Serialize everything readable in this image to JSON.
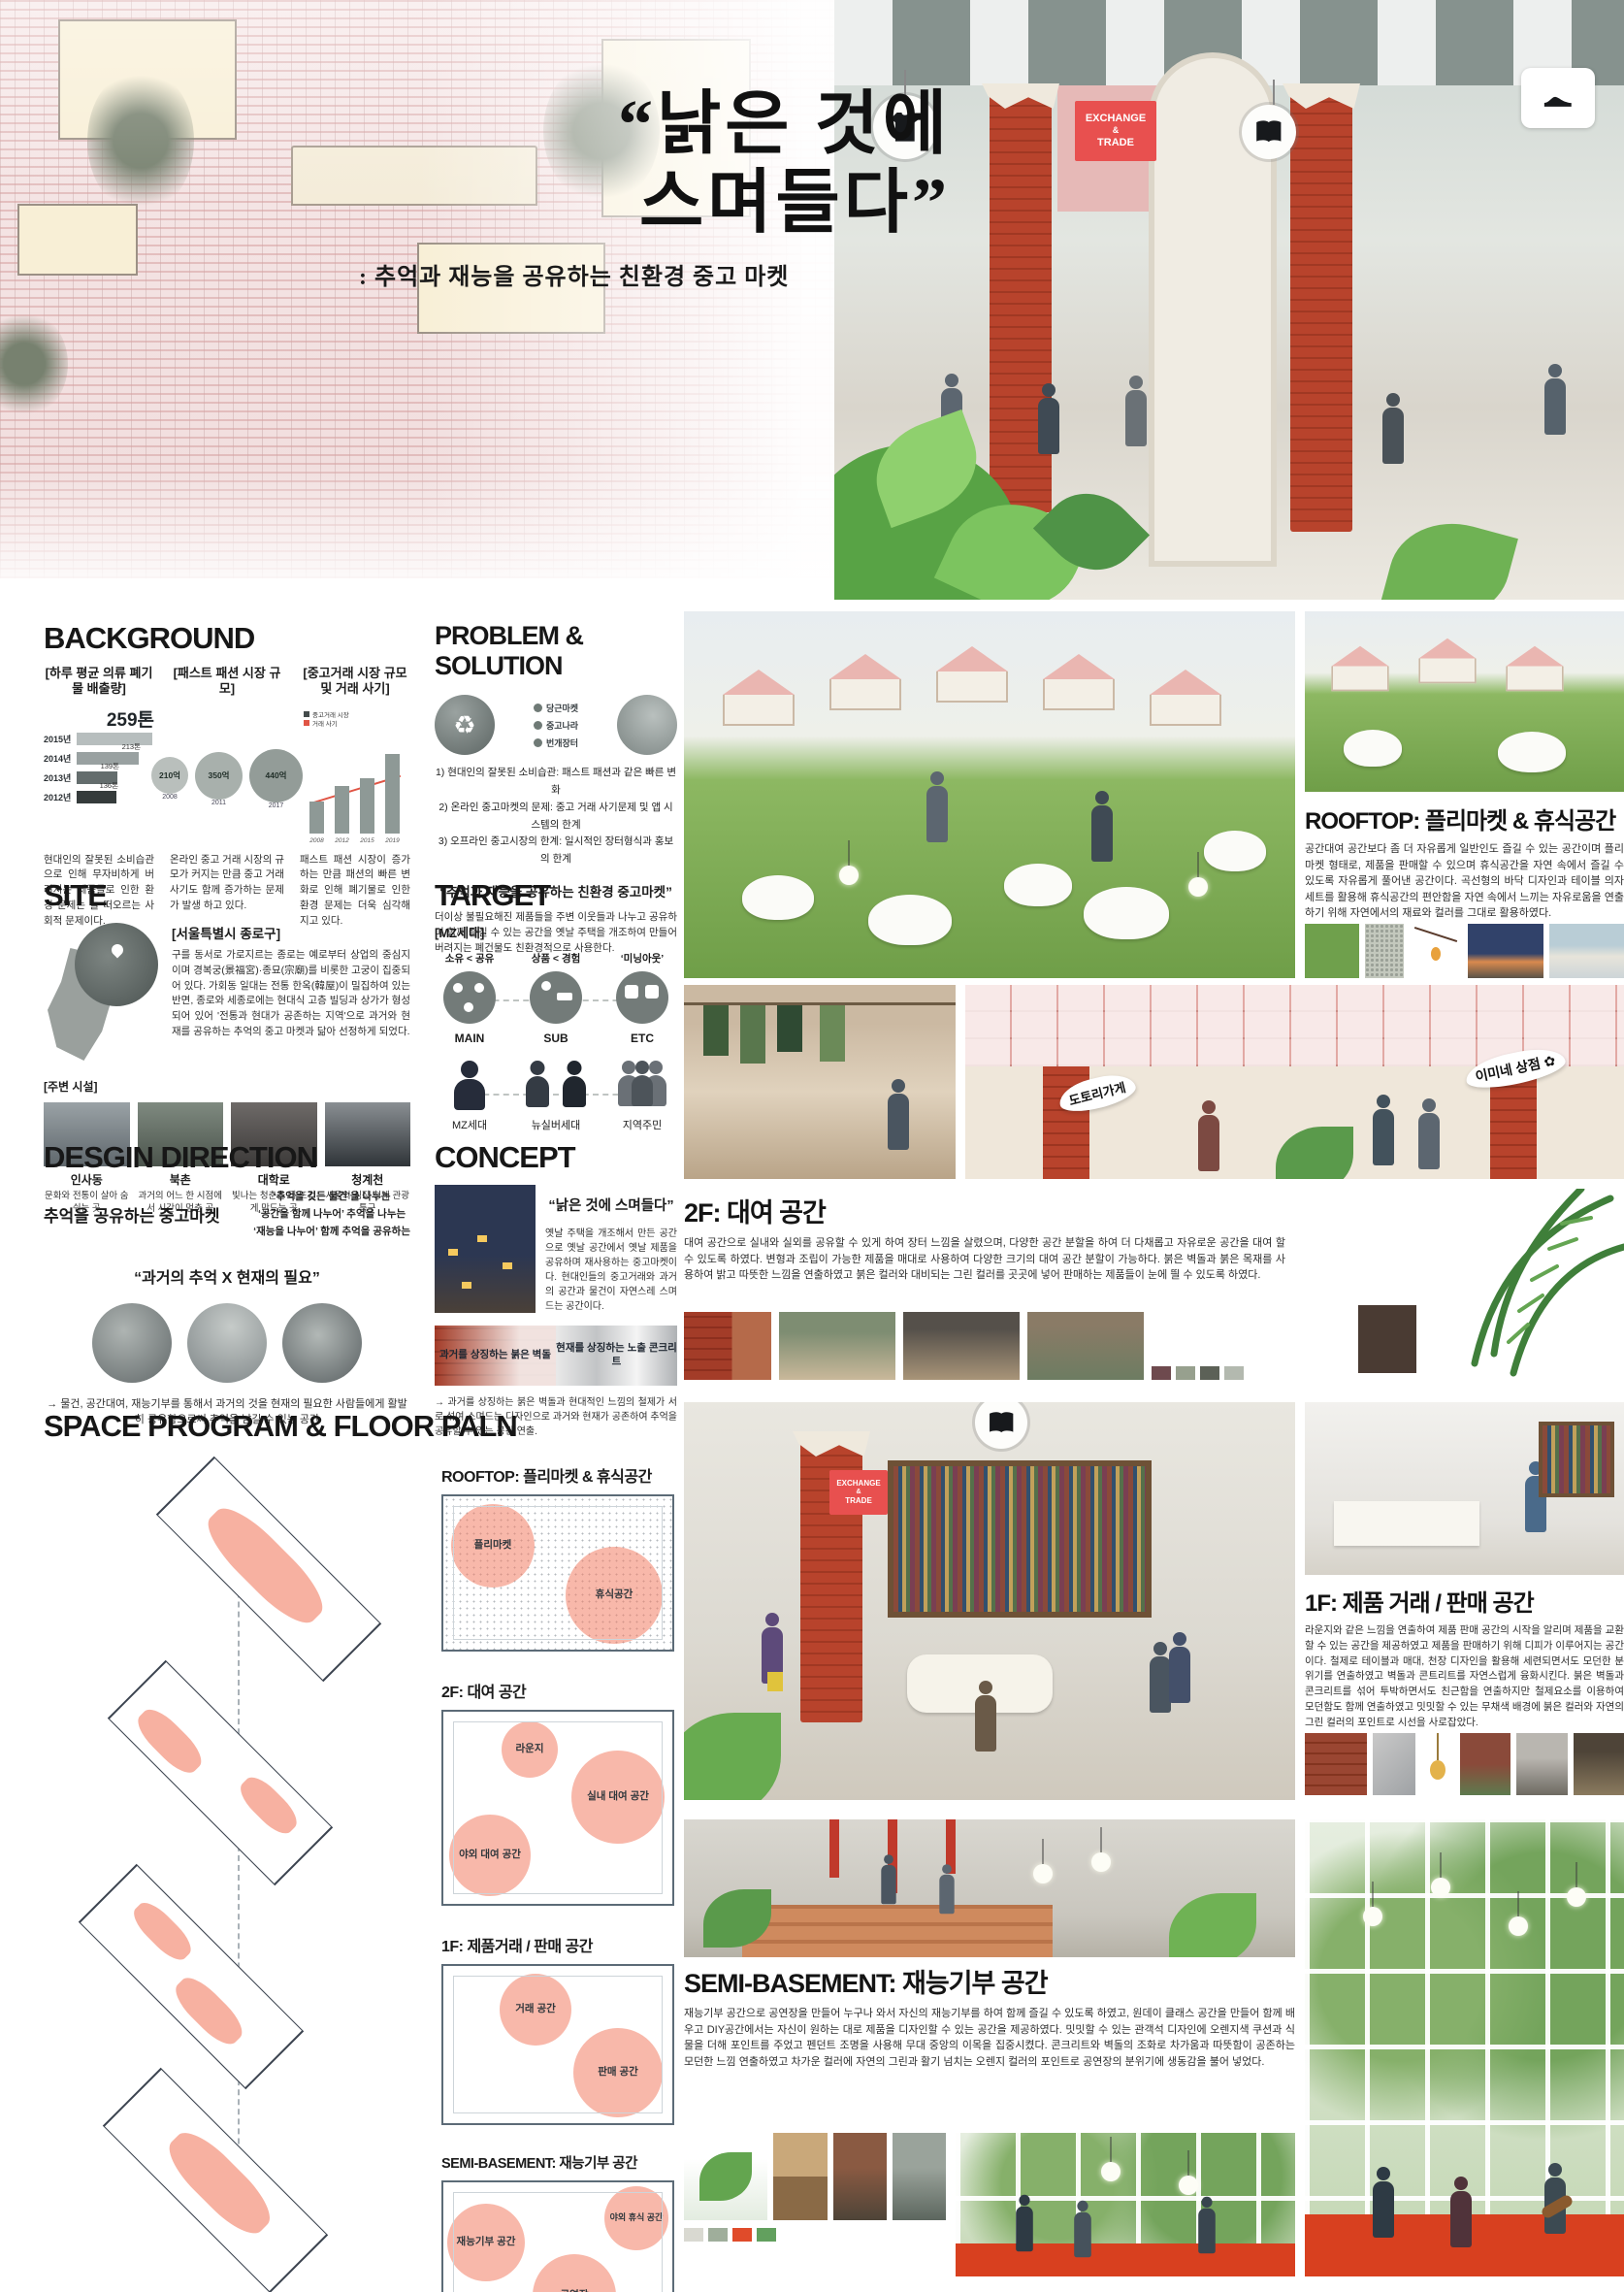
{
  "colors": {
    "accent_pink": "#f2a08e",
    "zone_pink": "#f07d64",
    "brick_red": "#b8432c",
    "sign_red": "#e8504f",
    "leaf_green": "#6fb254"
  },
  "hero": {
    "title_line1": "“낡은 것에",
    "title_line2": "스며들다”",
    "subtitle": ": 추억과 재능을 공유하는 친환경 중고 마켓",
    "sign": {
      "line1": "EXCHANGE",
      "amp": "&",
      "line2": "TRADE"
    }
  },
  "background": {
    "title": "BACKGROUND",
    "charts": [
      {
        "label": "[하루 평균 의류 폐기물 배출량]",
        "highlight": "259톤",
        "desc": "현대인의 잘못된 소비습관 으로 인해 무자비하게 버려지는 제품들로 인한 환경 문제는 늘 떠오르는 사회적 문제이다."
      },
      {
        "label": "[패스트 패션 시장 규모]",
        "desc": "온라인 중고 거래 시장의 규모가 커지는 만큼 중고 거래 사기도 함께 증가하는 문제가 발생 하고 있다."
      },
      {
        "label": "[중고거래 시장 규모 및 거래 사기]",
        "desc": "패스트 패션 시장이 증가하는 만큼 패션의 빠른 변화로 인해 폐기물로 인한 환경 문제는 더욱 심각해지고 있다."
      }
    ]
  },
  "problem_solution": {
    "title": "PROBLEM & SOLUTION",
    "apps": [
      "당근마켓",
      "중고나라",
      "번개장터"
    ],
    "items": [
      "1) 현대인의 잘못된 소비습관: 패스트 패션과 같은 빠른 변화",
      "2) 온라인 중고마켓의 문제: 중고 거래 사기문제 및 앱 시스템의 한계",
      "3) 오프라인 중고시장의 한계: 일시적인 장터형식과 홍보의 한계"
    ],
    "quote": "“추억과 재능을 공유하는 친환경 중고마켓”",
    "desc": "더이상 불필요해진 제품들을 주변 이웃들과 나누고 공유하며 함께 즐길 수 있는 공간을 옛날 주택을 개조하여 만들어 버려지는 폐건물도 친환경적으로 사용한다."
  },
  "site": {
    "title": "SITE",
    "location_label": "[서울특별시 종로구]",
    "desc": "구를 동서로 가로지르는 종로는 예로부터 상업의 중심지이며 경복궁(景福宮)·종묘(宗廟)를 비롯한 고궁이 집중되어 있다. 가회동 일대는 전통 한옥(韓屋)이 밀집하여 있는 반면, 종로와 세종로에는 현대식 고층 빌딩과 상가가 형성되어 있어 '전통과 현대가 공존하는 지역'으로 과거와 현재를 공유하는 추억의 중고 마켓과 닮아 선정하게 되었다.",
    "nearby_label": "[주변 시설]",
    "places": [
      {
        "name": "인사동",
        "desc": "문화와 전통이 살아 숨쉬는 곳"
      },
      {
        "name": "북촌",
        "desc": "과거의 어느 한 시점에서 시간이 멈춘 곳"
      },
      {
        "name": "대학로",
        "desc": "빛나는 청춘을 더 뜨겁게 만드는 곳"
      },
      {
        "name": "청계천",
        "desc": "서울의 심장 청계 관광특구"
      }
    ]
  },
  "target": {
    "title": "TARGET",
    "gen_label": "[MZ세대]",
    "traits": [
      "소유 < 공유",
      "상품 < 경험",
      "‘미닝아웃’"
    ],
    "tiers": [
      "MAIN",
      "SUB",
      "ETC"
    ],
    "groups": [
      "MZ세대",
      "뉴실버세대",
      "지역주민"
    ]
  },
  "design_direction": {
    "title": "DESGIN DIRECTION",
    "phrase": "추억을 공유하는 중고마켓",
    "notes": [
      "‘추억을 깃든 물건’을 나누는",
      "‘공간을 함께 나누어’ 추억을 나누는",
      "‘재능을 나누어’ 함께 추억을 공유하는"
    ],
    "quote": "“과거의 추억 X 현재의 필요”",
    "conclusion": "→ 물건, 공간대여, 재능기부를 통해서 과거의 것을 현재의 필요한 사람들에게 활발히 공유함으로써 추억을 남길 수 있는 공간"
  },
  "concept": {
    "title": "CONCEPT",
    "quote": "“낡은 것에 스며들다”",
    "desc": "옛날 주택을 개조해서 만든 공간으로 옛날 공간에서 옛날 제품을 공유하며 재사용하는 중고마켓이다. 현대인들의 중고거래와 과거의 공간과 물건이 자연스레 스며드는 공간이다.",
    "materials": [
      "과거를 상징하는 붉은 벽돌",
      "현재를 상징하는 노출 콘크리트"
    ],
    "conclusion": "→ 과거를 상징하는 붉은 벽돌과 현대적인 느낌의 철제가 서로 섞여 스며드는 디자인으로 과거와 현재가 공존하여 추억을 공유할 수 있는 공간 연출."
  },
  "space_program": {
    "title": "SPACE PROGRAM & FLOOR PALN",
    "plans": [
      {
        "heading": "ROOFTOP: 플리마켓 & 휴식공간",
        "zones": [
          "플리마켓",
          "휴식공간"
        ]
      },
      {
        "heading": "2F: 대여 공간",
        "zones": [
          "라운지",
          "실내 대여 공간",
          "야외 대여 공간"
        ]
      },
      {
        "heading": "1F: 제품거래 / 판매 공간",
        "zones": [
          "거래 공간",
          "판매 공간"
        ]
      },
      {
        "heading": "SEMI-BASEMENT: 재능기부 공간",
        "zones": [
          "재능기부 공간",
          "공연장",
          "야외 휴식 공간"
        ]
      }
    ]
  },
  "rooftop": {
    "title": "ROOFTOP: 플리마켓 & 휴식공간",
    "desc": "공간대여 공간보다 좀 더 자유롭게 일반인도 즐길 수 있는 공간이며 플리마켓 형태로, 제품을 판매할 수 있으며 휴식공간을 자연 속에서 즐길 수 있도록 자유롭게 풀어낸 공간이다. 곡선형의 바닥 디자인과 테이블 의자 세트를 활용해 휴식공간의 편안함을 자연 속에서 느끼는 자유로움을 연출하기 위해 자연에서의 재료와 컬러를 그대로 활용하였다."
  },
  "f2": {
    "title": "2F: 대여 공간",
    "desc": "대여 공간으로 실내와 실외를 공유할 수 있게 하여 장터 느낌을 살렸으며, 다양한 공간 분할을 하여 더 다채롭고 자유로운 공간을 대여 할 수 있도록 하였다. 변형과 조립이 가능한 제품을 매대로 사용하여 다양한 크기의 대여 공간 분할이 가능하다. 붉은 벽돌과 붉은 목재를 사용하여 밝고 따뜻한 느낌을 연출하였고 붉은 컬러와 대비되는 그린 컬러를 곳곳에 넣어 판매하는 제품들이 눈에 띌 수 있도록 하였다.",
    "banners": [
      "도토리가게",
      "이미네 상점"
    ],
    "palette": [
      "#6e4a4e",
      "#97a08e",
      "#5c6157",
      "#b3b9af"
    ]
  },
  "f1": {
    "title": "1F: 제품 거래 / 판매 공간",
    "desc": "라운지와 같은 느낌을 연출하여 제품 판매 공간의 시작을 알리며 제품을 교환할 수 있는 공간을 제공하였고 제품을 판매하기 위해 디피가 이루어지는 공간이다. 철제로 테이블과 매대, 천장 디자인을 활용해 세련되면서도 모던한 분위기를 연출하였고 벽돌과 콘트리트를 자연스럽게 융화시킨다. 붉은 벽돌과 콘크리트를 섞어 투박하면서도 친근함을 연출하지만 철제요소를 이용하여 모던함도 함께 연출하였고 밋밋할 수 있는 무채색 배경에 붉은 컬러와 자연의 그린 컬러의 포인트로 시선을 사로잡았다."
  },
  "sb": {
    "title": "SEMI-BASEMENT: 재능기부 공간",
    "desc": "재능기부 공간으로 공연장을 만들어 누구나 와서 자신의 재능기부를 하여 함께 즐길 수 있도록 하였고, 원데이 클래스 공간을 만들어 함께 배우고 DIY공간에서는 자신이 원하는 대로 제품을 디자인할 수 있는 공간을 제공하였다. 밋밋할 수 있는 관객석 디자인에 오렌지색 쿠션과 식물을 더해 포인트를 주었고 펜던트 조명을 사용해 무대 중앙의 이목을 집중시켰다. 콘크리트와 벽돌의 조화로 차가움과 따뜻함이 공존하는 모던한 느낌 연출하였고 차가운 컬러에 자연의 그린과 활기 넘치는 오렌지 컬러의 포인트로 공연장의 분위기에 생동감을 불어 넣었다.",
    "palette": [
      "#d9d9d1",
      "#9fae9b",
      "#e04b2a",
      "#62a05e"
    ]
  },
  "chart_data": [
    {
      "type": "bar",
      "orientation": "horizontal",
      "title": "[하루 평균 의류 폐기물 배출량]",
      "categories": [
        "2015년",
        "2014년",
        "2013년",
        "2012년"
      ],
      "values": [
        259,
        213,
        139,
        136
      ],
      "unit": "톤",
      "highlight_label": "259톤",
      "bar_colors": [
        "#b7bebe",
        "#99a1a1",
        "#646d6d",
        "#353b3b"
      ]
    },
    {
      "type": "bubble",
      "title": "[패스트 패션 시장 규모]",
      "categories": [
        "2008",
        "2011",
        "2017"
      ],
      "values": [
        210,
        350,
        440
      ],
      "labels": [
        "210억",
        "350억",
        "440억"
      ],
      "unit": "억 원",
      "bubble_colors": [
        "#b9bfbc",
        "#a8b0ac",
        "#939c98"
      ]
    },
    {
      "type": "bar",
      "title": "[중고거래 시장 규모 및 거래 사기]",
      "categories": [
        "2008",
        "2012",
        "2015",
        "2019"
      ],
      "series": [
        {
          "name": "중고거래 시장",
          "values": [
            8,
            12,
            14,
            20
          ]
        },
        {
          "name": "거래 사기",
          "values": [
            2,
            5,
            9,
            17
          ]
        }
      ],
      "unit": "조 원(추정)",
      "trend_line": true,
      "legend_colors": [
        "#444b4b",
        "#e05545"
      ]
    }
  ]
}
